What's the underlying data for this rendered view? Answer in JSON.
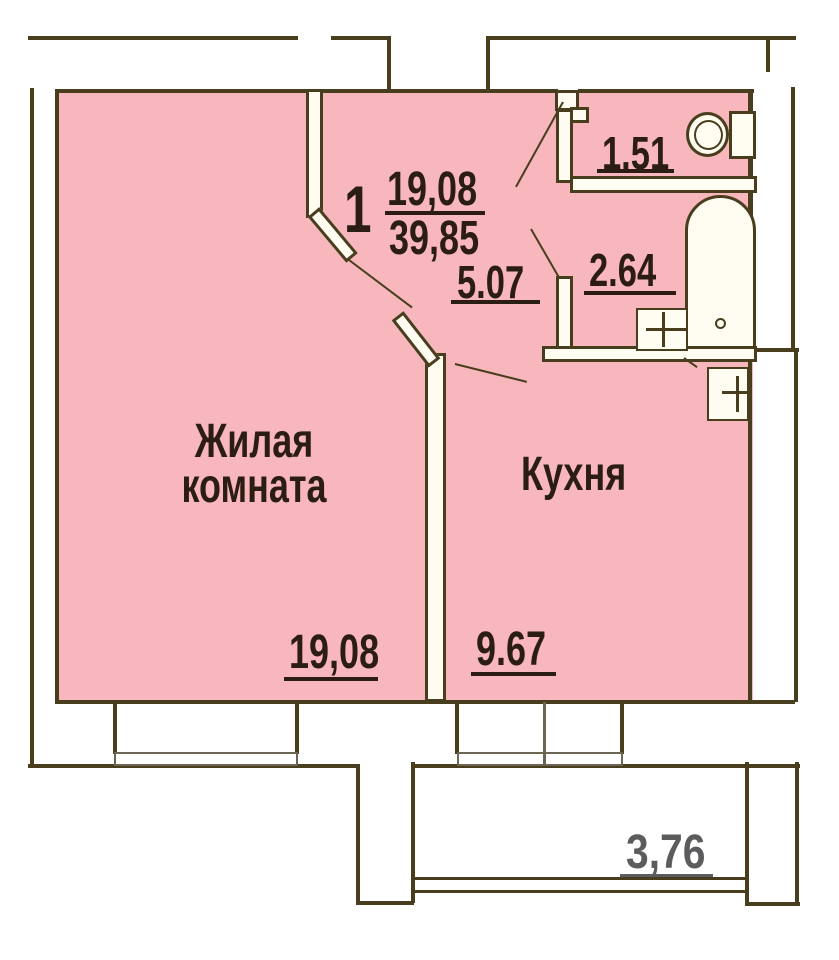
{
  "title": "Floor plan of one-room apartment",
  "apartment": {
    "number": "1",
    "living_area": "19,08",
    "total_area": "39,85"
  },
  "rooms": {
    "living": {
      "name_line1": "Жилая",
      "name_line2": "комната",
      "area": "19,08"
    },
    "kitchen": {
      "name": "Кухня",
      "area": "9.67"
    },
    "hallway": {
      "area": "5.07"
    },
    "bathroom": {
      "area": "2.64"
    },
    "toilet": {
      "area": "1.51"
    },
    "balcony": {
      "area": "3,76"
    }
  },
  "colors": {
    "floor_fill": "#f8b7bc",
    "wall_outline": "#483e1e",
    "wall_fill": "#fffdf2",
    "label_text": "#2b1d12",
    "balcony_label_text": "#5c5c5e",
    "window_frame": "#6b6552"
  }
}
